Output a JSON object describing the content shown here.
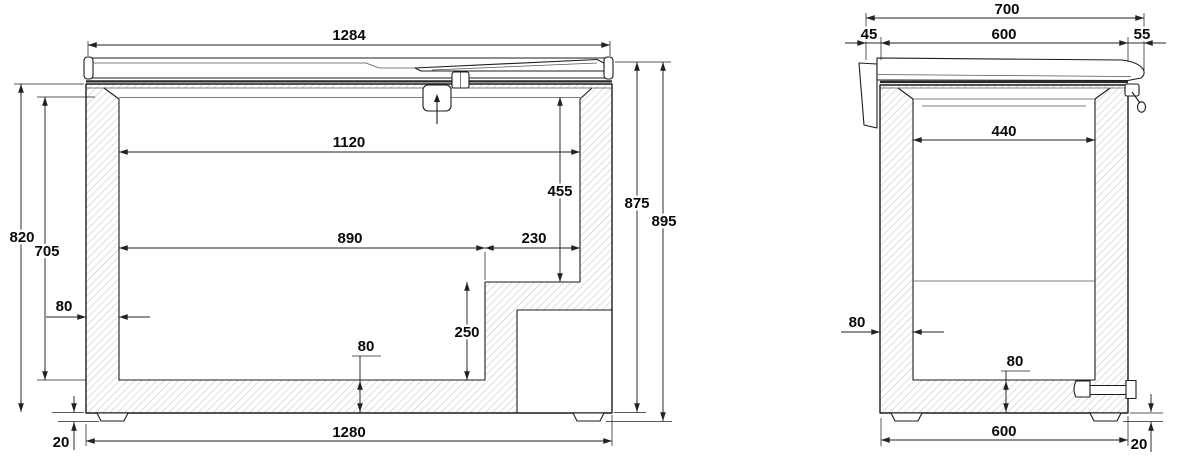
{
  "drawing": {
    "type": "technical-dimension-drawing",
    "subject": "chest freezer sectional views (front section and side section), dimensions in mm",
    "colors": {
      "line": "#1c1c1c",
      "dim": "#222222",
      "hatch": "#ccc2c2",
      "bg": "#ffffff",
      "fine": "#555555"
    }
  },
  "front_section": {
    "dims": {
      "lid_width": "1284",
      "inner_width_top": "1120",
      "inner_depth_upper": "455",
      "inner_width_lower": "890",
      "step_width": "230",
      "step_height": "250",
      "wall_thickness": "80",
      "floor_thickness": "80",
      "body_height": "820",
      "inner_depth": "705",
      "foot_height": "20",
      "base_width": "1280",
      "height_without_feet": "875",
      "overall_height": "895"
    }
  },
  "side_section": {
    "dims": {
      "overall_width": "700",
      "hinge_overhang": "45",
      "body_width": "600",
      "handle_overhang": "55",
      "inner_width": "440",
      "wall_thickness": "80",
      "floor_thickness": "80",
      "base_width": "600",
      "foot_height": "20"
    }
  }
}
